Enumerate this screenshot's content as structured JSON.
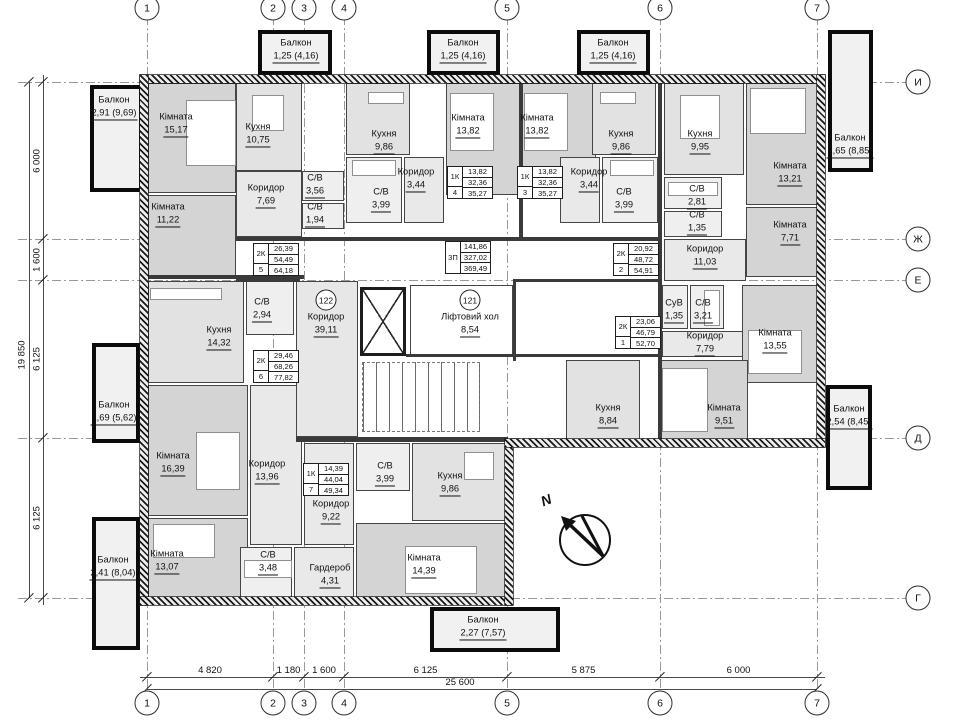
{
  "colors": {
    "wall": "#1a1a1a",
    "room_border": "#454545",
    "fills": {
      "room": "#d4d4d4",
      "kitchen": "#e2e2e2",
      "hall": "#e9e9e9",
      "bath": "#efefef",
      "common": "#e7e7e7",
      "lift": "#ffffff",
      "balcony": "#f1f1f1"
    }
  },
  "axes": {
    "columns": [
      {
        "label": "1",
        "x": 147
      },
      {
        "label": "2",
        "x": 273
      },
      {
        "label": "3",
        "x": 304
      },
      {
        "label": "4",
        "x": 344
      },
      {
        "label": "5",
        "x": 507
      },
      {
        "label": "6",
        "x": 660
      },
      {
        "label": "7",
        "x": 817
      }
    ],
    "rows": [
      {
        "label": "И",
        "y": 82
      },
      {
        "label": "Ж",
        "y": 239
      },
      {
        "label": "Е",
        "y": 280
      },
      {
        "label": "Д",
        "y": 438
      },
      {
        "label": "Г",
        "y": 598
      }
    ]
  },
  "dimensions": {
    "bottom_segments": [
      {
        "label": "4 820",
        "from": 147,
        "to": 273
      },
      {
        "label": "1 180",
        "from": 273,
        "to": 304
      },
      {
        "label": "1 600",
        "from": 304,
        "to": 344
      },
      {
        "label": "6 125",
        "from": 344,
        "to": 507
      },
      {
        "label": "5 875",
        "from": 507,
        "to": 660
      },
      {
        "label": "6 000",
        "from": 660,
        "to": 817
      }
    ],
    "bottom_total": {
      "label": "25 600",
      "from": 147,
      "to": 817
    },
    "left_segments": [
      {
        "label": "6 000",
        "from": 82,
        "to": 239
      },
      {
        "label": "1 600",
        "from": 239,
        "to": 280
      },
      {
        "label": "6 125",
        "from": 280,
        "to": 438
      },
      {
        "label": "6 125",
        "from": 438,
        "to": 598
      }
    ],
    "left_total": {
      "label": "19 850",
      "from": 82,
      "to": 598
    }
  },
  "walls_exterior": [
    [
      140,
      75,
      685,
      8
    ],
    [
      140,
      75,
      8,
      530
    ],
    [
      817,
      75,
      8,
      372
    ],
    [
      140,
      597,
      372,
      8
    ],
    [
      505,
      447,
      8,
      158
    ],
    [
      505,
      439,
      320,
      8
    ]
  ],
  "walls_interior": [
    [
      236,
      237,
      426,
      4
    ],
    [
      148,
      275,
      156,
      4
    ],
    [
      236,
      279,
      64,
      3
    ],
    [
      513,
      279,
      149,
      3
    ],
    [
      658,
      83,
      4,
      356
    ],
    [
      513,
      281,
      3,
      80
    ],
    [
      406,
      354,
      256,
      3
    ],
    [
      296,
      437,
      212,
      5
    ],
    [
      519,
      83,
      4,
      154
    ]
  ],
  "rooms": [
    {
      "name": "Кімната",
      "area": "15,17",
      "kind": "room",
      "box": [
        148,
        83,
        88,
        110
      ],
      "label": [
        176,
        124
      ]
    },
    {
      "name": "Кухня",
      "area": "10,75",
      "kind": "kitchen",
      "box": [
        236,
        83,
        66,
        88
      ],
      "label": [
        258,
        134
      ]
    },
    {
      "name": "Коридор",
      "area": "7,69",
      "kind": "hall",
      "box": [
        236,
        171,
        66,
        66
      ],
      "label": [
        266,
        195
      ]
    },
    {
      "name": "Кімната",
      "area": "11,22",
      "kind": "room",
      "box": [
        148,
        195,
        88,
        82
      ],
      "label": [
        168,
        214
      ]
    },
    {
      "name": "С/В",
      "area": "3,56",
      "kind": "bath",
      "box": [
        302,
        171,
        42,
        30
      ],
      "label": [
        315,
        185
      ]
    },
    {
      "name": "С/В",
      "area": "1,94",
      "kind": "bath",
      "box": [
        302,
        203,
        42,
        26
      ],
      "label": [
        315,
        214
      ]
    },
    {
      "name": "Кухня",
      "area": "9,86",
      "kind": "kitchen",
      "box": [
        346,
        83,
        64,
        72
      ],
      "label": [
        384,
        141
      ]
    },
    {
      "name": "С/В",
      "area": "3,99",
      "kind": "bath",
      "box": [
        346,
        157,
        56,
        66
      ],
      "label": [
        381,
        199
      ]
    },
    {
      "name": "Коридор",
      "area": "3,44",
      "kind": "hall",
      "box": [
        404,
        157,
        40,
        66
      ],
      "label": [
        416,
        179
      ]
    },
    {
      "name": "Кімната",
      "area": "13,82",
      "kind": "room",
      "box": [
        446,
        83,
        74,
        112
      ],
      "label": [
        468,
        125
      ]
    },
    {
      "name": "Кімната",
      "area": "13,82",
      "kind": "room",
      "box": [
        522,
        83,
        74,
        112
      ],
      "label": [
        537,
        125
      ]
    },
    {
      "name": "Коридор",
      "area": "3,44",
      "kind": "hall",
      "box": [
        560,
        157,
        40,
        66
      ],
      "label": [
        589,
        179
      ]
    },
    {
      "name": "Кухня",
      "area": "9,86",
      "kind": "kitchen",
      "box": [
        592,
        83,
        64,
        72
      ],
      "label": [
        621,
        141
      ]
    },
    {
      "name": "С/В",
      "area": "3,99",
      "kind": "bath",
      "box": [
        602,
        157,
        56,
        66
      ],
      "label": [
        624,
        199
      ]
    },
    {
      "name": "Кухня",
      "area": "9,95",
      "kind": "kitchen",
      "box": [
        664,
        83,
        80,
        92
      ],
      "label": [
        700,
        141
      ]
    },
    {
      "name": "С/В",
      "area": "2,81",
      "kind": "bath",
      "box": [
        664,
        177,
        58,
        32
      ],
      "label": [
        697,
        196
      ]
    },
    {
      "name": "С/В",
      "area": "1,35",
      "kind": "bath",
      "box": [
        664,
        211,
        58,
        26
      ],
      "label": [
        697,
        222
      ]
    },
    {
      "name": "Кімната",
      "area": "13,21",
      "kind": "room",
      "box": [
        746,
        83,
        74,
        122
      ],
      "label": [
        790,
        173
      ]
    },
    {
      "name": "Кімната",
      "area": "7,71",
      "kind": "room",
      "box": [
        746,
        207,
        74,
        70
      ],
      "label": [
        790,
        232
      ]
    },
    {
      "name": "Коридор",
      "area": "11,03",
      "kind": "hall",
      "box": [
        664,
        239,
        82,
        42
      ],
      "label": [
        705,
        256
      ]
    },
    {
      "name": "СуВ",
      "area": "1,35",
      "kind": "bath",
      "box": [
        662,
        285,
        26,
        44
      ],
      "label": [
        674,
        310
      ]
    },
    {
      "name": "С/В",
      "area": "3,21",
      "kind": "bath",
      "box": [
        690,
        285,
        34,
        44
      ],
      "label": [
        703,
        310
      ]
    },
    {
      "name": "Коридор",
      "area": "7,79",
      "kind": "hall",
      "box": [
        662,
        331,
        86,
        26
      ],
      "label": [
        705,
        343
      ]
    },
    {
      "name": "Кімната",
      "area": "13,55",
      "kind": "room",
      "box": [
        742,
        285,
        78,
        98
      ],
      "label": [
        775,
        340
      ]
    },
    {
      "name": "Кухня",
      "area": "8,84",
      "kind": "kitchen",
      "box": [
        566,
        360,
        74,
        85
      ],
      "label": [
        608,
        415
      ]
    },
    {
      "name": "Кімната",
      "area": "9,51",
      "kind": "room",
      "box": [
        660,
        360,
        88,
        85
      ],
      "label": [
        724,
        415
      ]
    },
    {
      "name": "Кухня",
      "area": "14,32",
      "kind": "kitchen",
      "box": [
        148,
        281,
        96,
        102
      ],
      "label": [
        219,
        337
      ]
    },
    {
      "name": "С/В",
      "area": "2,94",
      "kind": "bath",
      "box": [
        246,
        281,
        48,
        54
      ],
      "label": [
        262,
        309
      ]
    },
    {
      "name": "Кімната",
      "area": "16,39",
      "kind": "room",
      "box": [
        148,
        385,
        100,
        131
      ],
      "label": [
        173,
        463
      ]
    },
    {
      "name": "Коридор",
      "area": "13,96",
      "kind": "hall",
      "box": [
        250,
        385,
        52,
        160
      ],
      "label": [
        267,
        471
      ]
    },
    {
      "name": "Кімната",
      "area": "13,07",
      "kind": "room",
      "box": [
        148,
        518,
        100,
        80
      ],
      "label": [
        167,
        561
      ]
    },
    {
      "name": "С/В",
      "area": "3,48",
      "kind": "bath",
      "box": [
        240,
        547,
        52,
        51
      ],
      "label": [
        268,
        562
      ]
    },
    {
      "name": "Гардероб",
      "area": "4,31",
      "kind": "hall",
      "box": [
        294,
        547,
        60,
        51
      ],
      "label": [
        330,
        575
      ]
    },
    {
      "name": "С/В",
      "area": "3,99",
      "kind": "bath",
      "box": [
        356,
        443,
        54,
        48
      ],
      "label": [
        385,
        473
      ]
    },
    {
      "name": "Коридор",
      "area": "9,22",
      "kind": "hall",
      "box": [
        304,
        443,
        50,
        102
      ],
      "label": [
        331,
        511
      ]
    },
    {
      "name": "Кухня",
      "area": "9,86",
      "kind": "kitchen",
      "box": [
        412,
        443,
        94,
        78
      ],
      "label": [
        450,
        483
      ]
    },
    {
      "name": "Кімната",
      "area": "14,39",
      "kind": "room",
      "box": [
        356,
        523,
        150,
        75
      ],
      "label": [
        424,
        565
      ]
    },
    {
      "name": "Коридор",
      "area": "39,11",
      "kind": "common",
      "box": [
        296,
        281,
        62,
        156
      ],
      "label": [
        326,
        324
      ],
      "badge": "122",
      "badge_pos": [
        326,
        300
      ]
    },
    {
      "name": "Ліфтовий хол",
      "area": "8,54",
      "kind": "lift",
      "box": [
        410,
        285,
        103,
        71
      ],
      "label": [
        470,
        324
      ],
      "badge": "121",
      "badge_pos": [
        470,
        300
      ]
    }
  ],
  "balconies": [
    {
      "name": "Балкон",
      "area": "2,91 (9,69)",
      "box": [
        90,
        85,
        53,
        107
      ],
      "label": [
        114,
        107
      ]
    },
    {
      "name": "Балкон",
      "area": "1,69 (5,62)",
      "box": [
        92,
        343,
        48,
        100
      ],
      "label": [
        114,
        412
      ]
    },
    {
      "name": "Балкон",
      "area": "2,41 (8,04)",
      "box": [
        92,
        517,
        48,
        133
      ],
      "label": [
        113,
        567
      ]
    },
    {
      "name": "Балкон",
      "area": "1,25 (4,16)",
      "box": [
        258,
        30,
        74,
        45
      ],
      "label": [
        296,
        50
      ]
    },
    {
      "name": "Балкон",
      "area": "1,25 (4,16)",
      "box": [
        427,
        30,
        73,
        45
      ],
      "label": [
        463,
        50
      ]
    },
    {
      "name": "Балкон",
      "area": "1,25 (4,16)",
      "box": [
        577,
        30,
        73,
        45
      ],
      "label": [
        613,
        50
      ]
    },
    {
      "name": "Балкон",
      "area": "2,65 (8,85)",
      "box": [
        828,
        30,
        45,
        142
      ],
      "label": [
        850,
        145
      ]
    },
    {
      "name": "Балкон",
      "area": "2,54 (8,45)",
      "box": [
        826,
        385,
        46,
        105
      ],
      "label": [
        849,
        416
      ]
    },
    {
      "name": "Балкон",
      "area": "2,27 (7,57)",
      "box": [
        430,
        607,
        130,
        45
      ],
      "label": [
        483,
        627
      ]
    }
  ],
  "tables": [
    {
      "type": "1К",
      "num": "4",
      "values": [
        "13,82",
        "32,36",
        "35,27"
      ],
      "pos": [
        447,
        166
      ]
    },
    {
      "type": "1К",
      "num": "3",
      "values": [
        "13,82",
        "32,36",
        "35,27"
      ],
      "pos": [
        517,
        166
      ]
    },
    {
      "type": "2К",
      "num": "5",
      "values": [
        "26,39",
        "54,49",
        "64,18"
      ],
      "pos": [
        253,
        243
      ]
    },
    {
      "type": "2К",
      "num": "2",
      "values": [
        "20,92",
        "48,72",
        "54,91"
      ],
      "pos": [
        613,
        243
      ]
    },
    {
      "type": "3П",
      "num": "",
      "values": [
        "141,86",
        "327,02",
        "369,49"
      ],
      "pos": [
        445,
        241
      ]
    },
    {
      "type": "2К",
      "num": "1",
      "values": [
        "23,06",
        "46,79",
        "52,70"
      ],
      "pos": [
        615,
        316
      ]
    },
    {
      "type": "2К",
      "num": "6",
      "values": [
        "29,46",
        "68,26",
        "77,82"
      ],
      "pos": [
        253,
        350
      ]
    },
    {
      "type": "1К",
      "num": "7",
      "values": [
        "14,39",
        "44,04",
        "49,34"
      ],
      "pos": [
        303,
        463
      ]
    }
  ],
  "core": {
    "lift_shaft": [
      360,
      287,
      46,
      69
    ],
    "stairs": [
      362,
      362,
      118,
      70
    ]
  },
  "furniture": [
    {
      "kind": "bed",
      "box": [
        186,
        100,
        50,
        66
      ]
    },
    {
      "kind": "bed",
      "box": [
        450,
        93,
        44,
        58
      ]
    },
    {
      "kind": "bed",
      "box": [
        524,
        93,
        44,
        58
      ]
    },
    {
      "kind": "bed",
      "box": [
        750,
        88,
        56,
        46
      ]
    },
    {
      "kind": "bed",
      "box": [
        196,
        432,
        44,
        58
      ]
    },
    {
      "kind": "sofa",
      "box": [
        153,
        524,
        62,
        34
      ]
    },
    {
      "kind": "bed",
      "box": [
        405,
        546,
        72,
        48
      ]
    },
    {
      "kind": "bed",
      "box": [
        662,
        368,
        46,
        64
      ]
    },
    {
      "kind": "bed",
      "box": [
        748,
        330,
        54,
        44
      ]
    },
    {
      "kind": "table",
      "box": [
        252,
        95,
        32,
        36
      ]
    },
    {
      "kind": "counter",
      "box": [
        150,
        288,
        72,
        12
      ]
    },
    {
      "kind": "tub",
      "box": [
        352,
        160,
        44,
        16
      ]
    },
    {
      "kind": "tub",
      "box": [
        610,
        160,
        44,
        16
      ]
    },
    {
      "kind": "tub",
      "box": [
        668,
        182,
        50,
        14
      ]
    },
    {
      "kind": "tub",
      "box": [
        704,
        290,
        16,
        36
      ]
    },
    {
      "kind": "tub",
      "box": [
        244,
        560,
        48,
        18
      ]
    },
    {
      "kind": "table",
      "box": [
        464,
        452,
        30,
        28
      ]
    },
    {
      "kind": "table",
      "box": [
        680,
        95,
        40,
        44
      ]
    },
    {
      "kind": "counter",
      "box": [
        368,
        92,
        36,
        12
      ]
    },
    {
      "kind": "counter",
      "box": [
        600,
        92,
        36,
        12
      ]
    }
  ],
  "compass": {
    "label": "N",
    "pos": [
      585,
      540
    ],
    "r": 26
  }
}
